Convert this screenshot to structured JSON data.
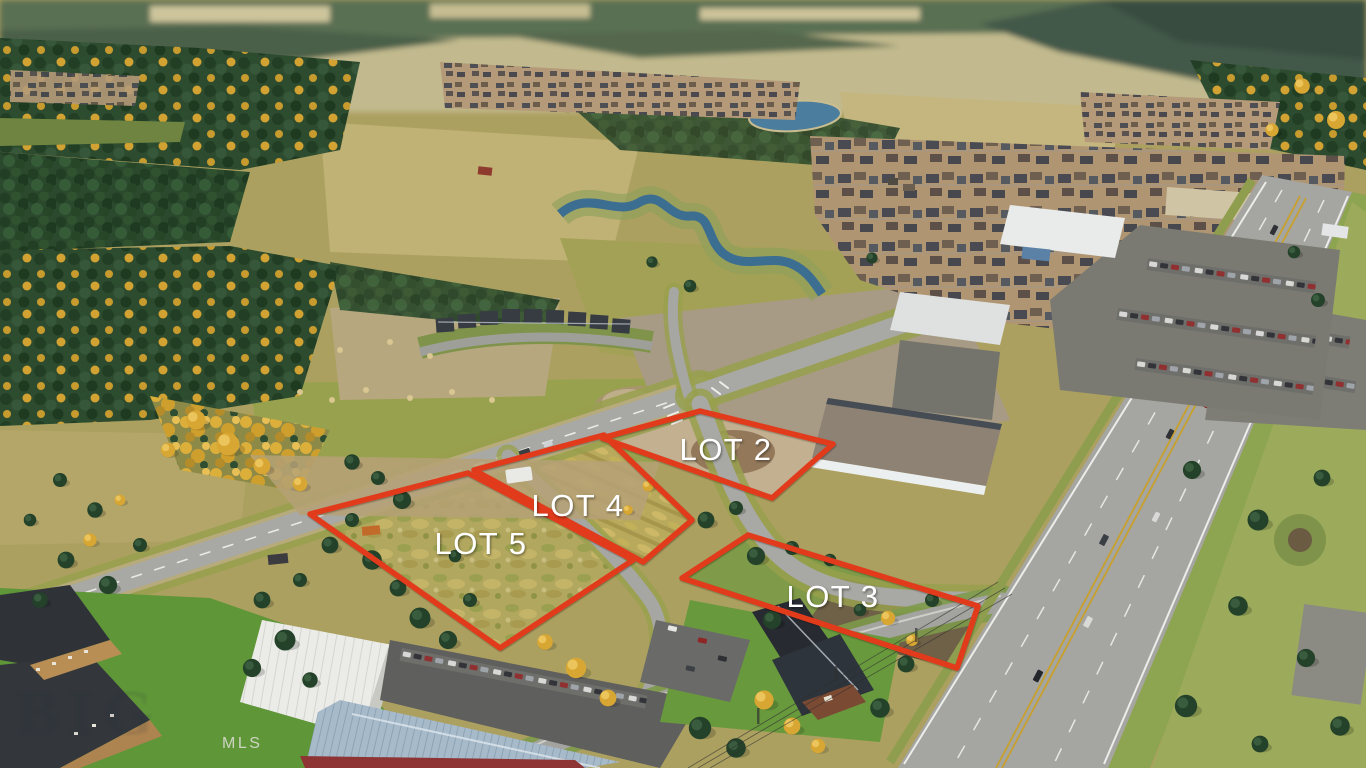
{
  "overlay": {
    "outline_color": "#e13a1f",
    "label_color": "#ffffff",
    "lots": [
      {
        "id": "lot-2",
        "label": "LOT 2"
      },
      {
        "id": "lot-3",
        "label": "LOT 3"
      },
      {
        "id": "lot-4",
        "label": "LOT 4"
      },
      {
        "id": "lot-5",
        "label": "LOT 5"
      }
    ]
  },
  "watermarks": {
    "mls": "MLS",
    "agency_faint": "BIG"
  },
  "scene": {
    "description": "Autumn aerial drone photo of four vacant lots outlined in red at a new road intersection beside a multi-lane highway, surrounded by conifer forest with golden larches, farm fields, a winding river and pond, dense suburban housing, commercial warehouses and a dark chalet-style office building.",
    "palette": {
      "conifer_green": "#2b4a2d",
      "larch_gold": "#d2a232",
      "field_olive": "#aca060",
      "field_pale": "#c0b175",
      "lawn_green": "#5f9638",
      "road_gray": "#a5a5a1",
      "asphalt_dark": "#5f5f5d",
      "water_blue": "#3c6e92",
      "roof_white": "#ebebe8",
      "roof_blue": "#a7bac9",
      "roof_dark": "#2e343b",
      "wall_red": "#8e3434"
    }
  }
}
